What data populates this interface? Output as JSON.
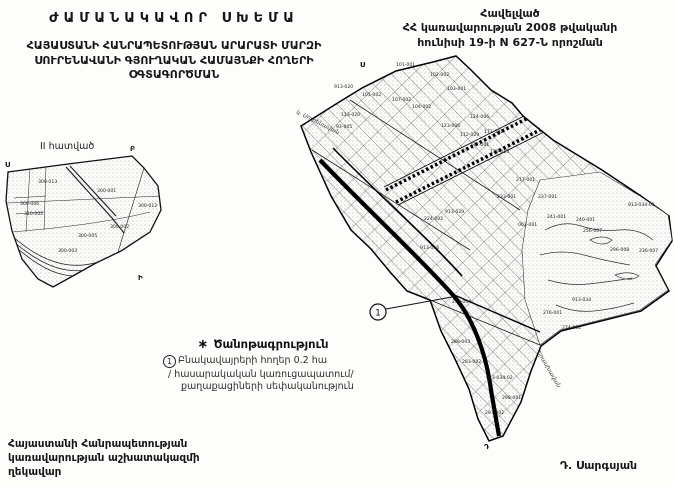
{
  "document": {
    "title": "ԺԱՄԱՆԱԿԱՎՈՐ ՍԽԵՄԱ",
    "subtitle_lines": [
      "ՀԱՅԱՍՏԱՆԻ ՀԱՆՐԱՊԵՏՈՒԹՅԱՆ ԱՐԱՐԱՏԻ ՄԱՐԶԻ",
      "ՍՈՒՐԵՆԱՎԱՆԻ ԳՅՈՒՂԱԿԱՆ ՀԱՄԱՅՆՔԻ ՀՈՂԵՐԻ",
      "ՕԳՏԱԳՈՐԾՄԱՆ"
    ],
    "appendix_lines": [
      "Հավելված",
      "ՀՀ կառավարության 2008 թվականի",
      "հունիսի 19-ի N 627-Ն որոշման"
    ],
    "signature_block_lines": [
      "Հայաստանի Հանրապետության",
      "կառավարության աշխատակազմի",
      "ղեկավար"
    ],
    "signature_name": "Դ. Սարգսյան"
  },
  "legend": {
    "symbol": "∗",
    "heading": "Ծանոթագրություն",
    "item_marker": "1",
    "item_lines": [
      "Բնակավայրերի հողեր   0.2 հա",
      "/ հասարակական կառուցապատում/",
      "քաղաքացիների սեփականություն"
    ]
  },
  "inset_map": {
    "name_label": "II հատված",
    "corner_letters": [
      {
        "t": "Ս",
        "x": 5,
        "y": 167
      },
      {
        "t": "Բ",
        "x": 130,
        "y": 151
      },
      {
        "t": "Ի",
        "x": 138,
        "y": 280
      }
    ],
    "parcel_labels": [
      {
        "t": "300-001",
        "x": 97,
        "y": 192
      },
      {
        "t": "300-013",
        "x": 38,
        "y": 183
      },
      {
        "t": "300-012",
        "x": 138,
        "y": 207
      },
      {
        "t": "300-006",
        "x": 20,
        "y": 205
      },
      {
        "t": "310-002",
        "x": 24,
        "y": 215
      },
      {
        "t": "300-005",
        "x": 78,
        "y": 237
      },
      {
        "t": "300-002",
        "x": 110,
        "y": 228
      },
      {
        "t": "300-003",
        "x": 58,
        "y": 252
      }
    ]
  },
  "main_map": {
    "edge_label_top": "կ. Սուրենավան",
    "edge_label_bottom": "Երասխավան",
    "annotation_marker": "1",
    "corner_letters": [
      {
        "t": "Ս",
        "x": 360,
        "y": 67
      },
      {
        "t": "Դ",
        "x": 484,
        "y": 449
      }
    ],
    "parcel_labels": [
      {
        "t": "101-001",
        "x": 396,
        "y": 66
      },
      {
        "t": "102-002",
        "x": 430,
        "y": 76
      },
      {
        "t": "103-001",
        "x": 447,
        "y": 90
      },
      {
        "t": "913-020",
        "x": 334,
        "y": 88
      },
      {
        "t": "101-002",
        "x": 362,
        "y": 96
      },
      {
        "t": "107-002",
        "x": 392,
        "y": 101
      },
      {
        "t": "104-002",
        "x": 412,
        "y": 108
      },
      {
        "t": "113-020",
        "x": 341,
        "y": 116
      },
      {
        "t": "93-005",
        "x": 336,
        "y": 128
      },
      {
        "t": "124-006",
        "x": 470,
        "y": 118
      },
      {
        "t": "123-006",
        "x": 441,
        "y": 127
      },
      {
        "t": "112-029",
        "x": 460,
        "y": 136
      },
      {
        "t": "171-001",
        "x": 484,
        "y": 133
      },
      {
        "t": "177-001",
        "x": 470,
        "y": 146
      },
      {
        "t": "179-013",
        "x": 490,
        "y": 153
      },
      {
        "t": "217-001",
        "x": 516,
        "y": 181
      },
      {
        "t": "237-001",
        "x": 538,
        "y": 198
      },
      {
        "t": "241-001",
        "x": 547,
        "y": 218
      },
      {
        "t": "240-001",
        "x": 576,
        "y": 221
      },
      {
        "t": "256-007",
        "x": 583,
        "y": 232
      },
      {
        "t": "913-034-01",
        "x": 628,
        "y": 206
      },
      {
        "t": "296-008",
        "x": 610,
        "y": 251
      },
      {
        "t": "236-007",
        "x": 639,
        "y": 252
      },
      {
        "t": "913-029",
        "x": 445,
        "y": 213
      },
      {
        "t": "224-002",
        "x": 424,
        "y": 220
      },
      {
        "t": "233-001",
        "x": 497,
        "y": 198
      },
      {
        "t": "003-001",
        "x": 518,
        "y": 226
      },
      {
        "t": "913-016",
        "x": 420,
        "y": 249
      },
      {
        "t": "253-004",
        "x": 452,
        "y": 303
      },
      {
        "t": "288-003",
        "x": 451,
        "y": 343
      },
      {
        "t": "276-001",
        "x": 543,
        "y": 314
      },
      {
        "t": "913-034",
        "x": 572,
        "y": 301
      },
      {
        "t": "274-002",
        "x": 562,
        "y": 329
      },
      {
        "t": "283-002",
        "x": 462,
        "y": 363
      },
      {
        "t": "913-034-02",
        "x": 486,
        "y": 379
      },
      {
        "t": "298-001",
        "x": 502,
        "y": 399
      },
      {
        "t": "297-002",
        "x": 485,
        "y": 414
      }
    ]
  }
}
